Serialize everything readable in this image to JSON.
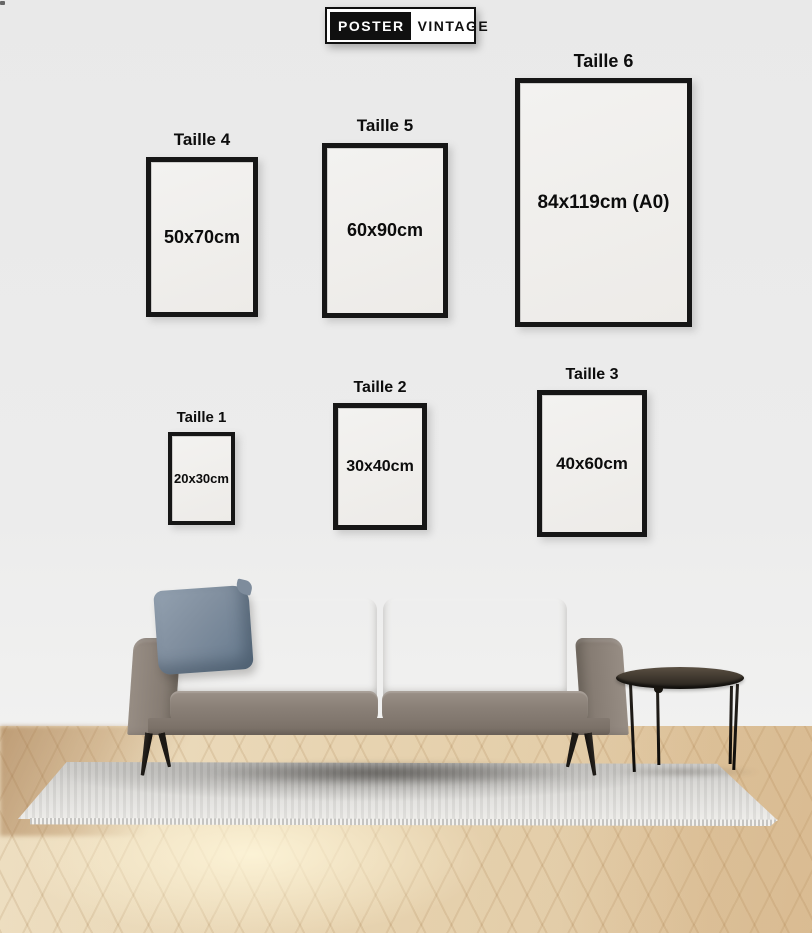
{
  "brand": {
    "poster": "POSTER",
    "vintage": "VINTAGE"
  },
  "size_guide": {
    "frames": [
      {
        "id": "taille-4",
        "label": "Taille 4",
        "size": "50x70cm"
      },
      {
        "id": "taille-5",
        "label": "Taille 5",
        "size": "60x90cm"
      },
      {
        "id": "taille-6",
        "label": "Taille 6",
        "size": "84x119cm (A0)"
      },
      {
        "id": "taille-1",
        "label": "Taille 1",
        "size": "20x30cm"
      },
      {
        "id": "taille-2",
        "label": "Taille 2",
        "size": "30x40cm"
      },
      {
        "id": "taille-3",
        "label": "Taille 3",
        "size": "40x60cm"
      }
    ]
  },
  "scene": {
    "colors": {
      "wall": "#ebebeb",
      "frame_border": "#161616",
      "label_text": "#0d0d0d",
      "logo_black": "#101010",
      "logo_white": "#ffffff",
      "sofa_body": "#8a8076",
      "pillow_blue": "#8290a0",
      "rug_gray": "#dcdbd8",
      "floor_wood": "#e5cfa9",
      "table_dark": "#3c352c"
    }
  }
}
